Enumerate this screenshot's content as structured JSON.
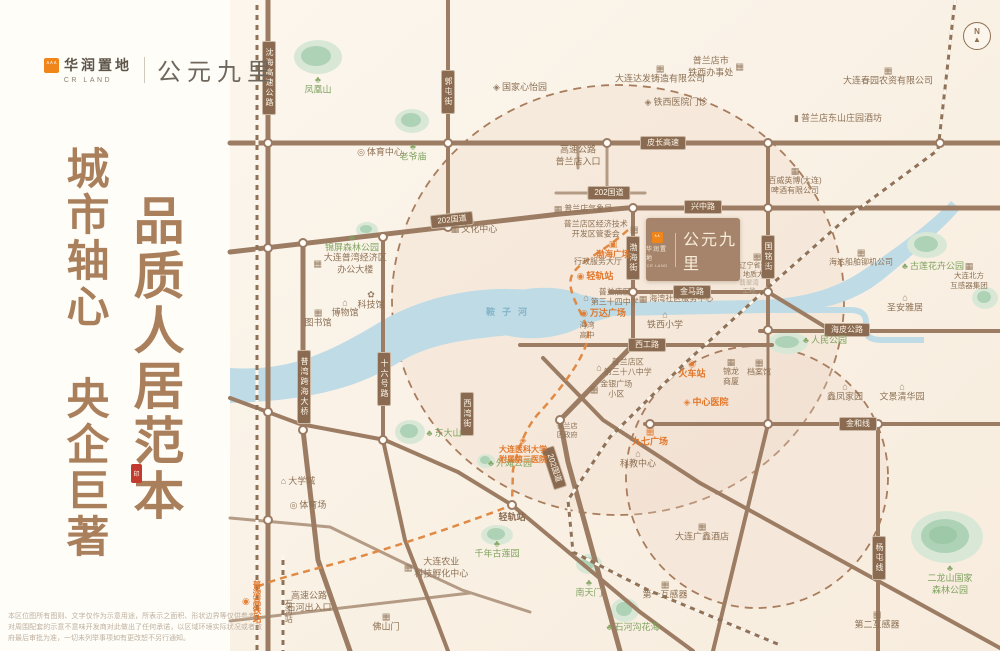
{
  "brand": {
    "logo_cn": "华润置地",
    "logo_en": "CR LAND",
    "project": "公元九里"
  },
  "slogan": {
    "col1": "城市轴心　央企巨著",
    "col2": "品质人居范本",
    "seal": "印"
  },
  "property": {
    "logo_cn": "华润置地",
    "logo_en": "CR LAND",
    "name": "公元九里"
  },
  "compass": {
    "label": "N"
  },
  "disclaimer": "本区位图所有图则、文字仅作为示意用途，所表示之面积、形状边界等仅供参考，对周围配套的示意不意味开发商对此做出了任何承诺，以区域环境实际状况或者政府最后审批为准，一切未列举事项如有更改恕不另行通知。",
  "map": {
    "colors": {
      "road": "#9c7c63",
      "road_minor": "#b49b85",
      "pill": "#8a6b52",
      "river": "#bedbe6",
      "park": "#b5d6bc",
      "orange": "#e2772a",
      "circle_dash": "#a87c5c"
    },
    "river_label": {
      "t": "鞍子河",
      "x": 510,
      "y": 313,
      "c": "bl",
      "ls": 7,
      "n": "river-label"
    },
    "road_labels": [
      {
        "t": "皮长高速",
        "x": 663,
        "y": 143
      },
      {
        "t": "202国道",
        "x": 452,
        "y": 220,
        "r": -6
      },
      {
        "t": "202国道",
        "x": 609,
        "y": 193
      },
      {
        "t": "兴中路",
        "x": 703,
        "y": 207
      },
      {
        "t": "金马路",
        "x": 692,
        "y": 292
      },
      {
        "t": "西工路",
        "x": 647,
        "y": 345
      },
      {
        "t": "海皮公路",
        "x": 847,
        "y": 330
      },
      {
        "t": "金和线",
        "x": 858,
        "y": 424
      },
      {
        "t": "沈海高速公路",
        "x": 269,
        "y": 78,
        "v": 1
      },
      {
        "t": "郭屯街",
        "x": 448,
        "y": 92,
        "v": 1
      },
      {
        "t": "渤海街",
        "x": 633,
        "y": 258,
        "v": 1
      },
      {
        "t": "国铭街",
        "x": 768,
        "y": 257,
        "v": 1
      },
      {
        "t": "十六号路",
        "x": 384,
        "y": 379,
        "v": 1
      },
      {
        "t": "普湾跨海大桥",
        "x": 304,
        "y": 387,
        "v": 1
      },
      {
        "t": "西湾街",
        "x": 467,
        "y": 414,
        "v": 1
      },
      {
        "t": "202国道",
        "x": 554,
        "y": 468,
        "r": 72
      },
      {
        "t": "杨屯线",
        "x": 879,
        "y": 558,
        "v": 1
      }
    ],
    "pois": [
      {
        "t": "凤凰山",
        "x": 318,
        "y": 86,
        "c": "g",
        "i": "tree",
        "ip": "t"
      },
      {
        "t": "老爷庙",
        "x": 413,
        "y": 153,
        "c": "g",
        "i": "tree",
        "ip": "t"
      },
      {
        "t": "锦屏森林公园",
        "x": 352,
        "y": 244,
        "c": "g",
        "i": "tree",
        "ip": "t"
      },
      {
        "t": "东大山",
        "x": 444,
        "y": 434,
        "c": "g",
        "i": "tree",
        "ip": "l"
      },
      {
        "t": "外滩公园",
        "x": 510,
        "y": 464,
        "c": "g",
        "i": "tree",
        "ip": "l"
      },
      {
        "t": "千年古莲园",
        "x": 497,
        "y": 550,
        "c": "g",
        "i": "tree",
        "ip": "t"
      },
      {
        "t": "南天门",
        "x": 589,
        "y": 589,
        "c": "g",
        "i": "tree",
        "ip": "t"
      },
      {
        "t": "石河沟花海",
        "x": 633,
        "y": 628,
        "c": "g",
        "i": "tree",
        "ip": "l"
      },
      {
        "t": "二龙山国家/森林公园",
        "x": 950,
        "y": 580,
        "c": "g",
        "i": "tree",
        "ip": "t"
      },
      {
        "t": "古莲花卉公园",
        "x": 933,
        "y": 267,
        "c": "g",
        "i": "tree",
        "ip": "l"
      },
      {
        "t": "人民公园",
        "x": 825,
        "y": 341,
        "c": "g",
        "i": "tree",
        "ip": "l"
      },
      {
        "t": "体育中心",
        "x": 380,
        "y": 153,
        "c": "b",
        "i": "ring",
        "ip": "l"
      },
      {
        "t": "国家心怡园",
        "x": 520,
        "y": 88,
        "c": "b",
        "i": "diamond",
        "ip": "l"
      },
      {
        "t": "文化中心",
        "x": 474,
        "y": 230,
        "c": "b",
        "i": "building",
        "ip": "l"
      },
      {
        "t": "大连普湾经济区/办公大楼",
        "x": 350,
        "y": 264,
        "c": "b",
        "i": "building",
        "ip": "l"
      },
      {
        "t": "科技馆",
        "x": 371,
        "y": 301,
        "c": "b",
        "i": "flower",
        "ip": "t"
      },
      {
        "t": "博物馆",
        "x": 345,
        "y": 309,
        "c": "b",
        "i": "house",
        "ip": "t"
      },
      {
        "t": "图书馆",
        "x": 318,
        "y": 319,
        "c": "b",
        "i": "building",
        "ip": "t"
      },
      {
        "t": "大学城",
        "x": 298,
        "y": 482,
        "c": "b",
        "i": "school",
        "ip": "l"
      },
      {
        "t": "体育场",
        "x": 308,
        "y": 506,
        "c": "b",
        "i": "ring",
        "ip": "l"
      },
      {
        "t": "高速公路/普兰店入口",
        "x": 578,
        "y": 156,
        "c": "b"
      },
      {
        "t": "大连达发铸造有限公司",
        "x": 660,
        "y": 75,
        "c": "b",
        "i": "factory",
        "ip": "t"
      },
      {
        "t": "普兰店市/铁西办事处",
        "x": 716,
        "y": 67,
        "c": "b",
        "i": "building",
        "ip": "r"
      },
      {
        "t": "铁西医院门诊",
        "x": 676,
        "y": 103,
        "c": "b",
        "i": "diamond",
        "ip": "l"
      },
      {
        "t": "普兰店气象局",
        "x": 583,
        "y": 209,
        "c": "b",
        "i": "building",
        "ip": "l",
        "s": 8
      },
      {
        "t": "普兰店区经济技术/开发区管委会",
        "x": 601,
        "y": 230,
        "c": "b",
        "i": "building",
        "ip": "r",
        "s": 8
      },
      {
        "t": "行政服务大厅",
        "x": 598,
        "y": 262,
        "c": "b",
        "s": 8
      },
      {
        "t": "普兰店区/第三十四中学",
        "x": 611,
        "y": 298,
        "c": "b",
        "i": "school",
        "ip": "l",
        "s": 8
      },
      {
        "t": "海湾/高中",
        "x": 587,
        "y": 330,
        "c": "b",
        "s": 7.5
      },
      {
        "t": "海湾社区服务中心",
        "x": 676,
        "y": 299,
        "c": "b",
        "i": "building",
        "ip": "l",
        "s": 8
      },
      {
        "t": "铁西小学",
        "x": 665,
        "y": 321,
        "c": "b",
        "i": "school",
        "ip": "t"
      },
      {
        "t": "普兰店区/第三十八中学",
        "x": 624,
        "y": 368,
        "c": "b",
        "i": "school",
        "ip": "l",
        "s": 8
      },
      {
        "t": "金银广场/小区",
        "x": 611,
        "y": 390,
        "c": "b",
        "i": "building",
        "ip": "l",
        "s": 8
      },
      {
        "t": "锦龙/商厦",
        "x": 731,
        "y": 373,
        "c": "b",
        "i": "building",
        "ip": "t",
        "s": 8
      },
      {
        "t": "档案馆",
        "x": 759,
        "y": 368,
        "c": "b",
        "i": "building",
        "ip": "t",
        "s": 8
      },
      {
        "t": "普兰店/区政府",
        "x": 567,
        "y": 431,
        "c": "b",
        "s": 7
      },
      {
        "t": "科教中心",
        "x": 638,
        "y": 460,
        "c": "b",
        "i": "house",
        "ip": "t"
      },
      {
        "t": "大连广鑫酒店",
        "x": 702,
        "y": 533,
        "c": "b",
        "i": "building",
        "ip": "t"
      },
      {
        "t": "第一互感器",
        "x": 665,
        "y": 591,
        "c": "b",
        "i": "building",
        "ip": "t"
      },
      {
        "t": "第二互感器",
        "x": 877,
        "y": 621,
        "c": "b",
        "i": "building",
        "ip": "t"
      },
      {
        "t": "大连农业/科技孵化中心",
        "x": 436,
        "y": 568,
        "c": "b",
        "i": "building",
        "ip": "l"
      },
      {
        "t": "高速公路/石河出入口",
        "x": 309,
        "y": 602,
        "c": "b"
      },
      {
        "t": "佛山门",
        "x": 386,
        "y": 623,
        "c": "b",
        "i": "building",
        "ip": "t"
      },
      {
        "t": "石河站",
        "x": 288,
        "y": 611,
        "c": "b",
        "v": 1,
        "s": 8
      },
      {
        "t": "轻轨站",
        "x": 512,
        "y": 518,
        "c": "bb"
      },
      {
        "t": "圣安雅居",
        "x": 905,
        "y": 304,
        "c": "b",
        "i": "house",
        "ip": "t"
      },
      {
        "t": "鑫凤家园",
        "x": 845,
        "y": 393,
        "c": "b",
        "i": "house",
        "ip": "t"
      },
      {
        "t": "文景清华园",
        "x": 902,
        "y": 393,
        "c": "b",
        "i": "house",
        "ip": "t"
      },
      {
        "t": "大连春园农资有限公司",
        "x": 888,
        "y": 77,
        "c": "b",
        "i": "building",
        "ip": "t"
      },
      {
        "t": "普兰店东山庄园酒坊",
        "x": 838,
        "y": 119,
        "c": "b",
        "i": "bottle",
        "ip": "l"
      },
      {
        "t": "百威英博(大连)/啤酒有限公司",
        "x": 795,
        "y": 182,
        "c": "b",
        "i": "building",
        "ip": "t",
        "s": 8
      },
      {
        "t": "海达船舶铆机公司",
        "x": 861,
        "y": 258,
        "c": "b",
        "i": "building",
        "ip": "t",
        "s": 8
      },
      {
        "t": "大连北方/互感器集团",
        "x": 969,
        "y": 276,
        "c": "b",
        "i": "building",
        "ip": "t",
        "s": 7.5
      },
      {
        "t": "辽宁省第六/地质大队",
        "x": 757,
        "y": 266,
        "c": "b",
        "i": "building",
        "ip": "t",
        "s": 7
      },
      {
        "t": "翡翠湾/工地",
        "x": 749,
        "y": 288,
        "c": "gy",
        "s": 6.5
      },
      {
        "t": "渤海广场",
        "x": 613,
        "y": 250,
        "c": "o",
        "i": "train",
        "ip": "t",
        "s": 8.5
      },
      {
        "t": "轻轨站",
        "x": 595,
        "y": 277,
        "c": "o",
        "i": "station",
        "ip": "l"
      },
      {
        "t": "万达广场",
        "x": 603,
        "y": 314,
        "c": "o",
        "i": "station",
        "ip": "l"
      },
      {
        "t": "火车站",
        "x": 692,
        "y": 370,
        "c": "o",
        "i": "station",
        "ip": "t"
      },
      {
        "t": "中心医院",
        "x": 706,
        "y": 403,
        "c": "o",
        "i": "diamond",
        "ip": "l"
      },
      {
        "t": "九七广场",
        "x": 650,
        "y": 438,
        "c": "o",
        "i": "building",
        "ip": "t"
      },
      {
        "t": "大连医科大学/附属第三医院",
        "x": 523,
        "y": 451,
        "c": "o",
        "i": "diamond",
        "ip": "t",
        "s": 8
      },
      {
        "t": "普湾高铁站",
        "x": 252,
        "y": 602,
        "c": "o",
        "i": "station",
        "ip": "b",
        "v": 1,
        "s": 8.5
      }
    ]
  }
}
